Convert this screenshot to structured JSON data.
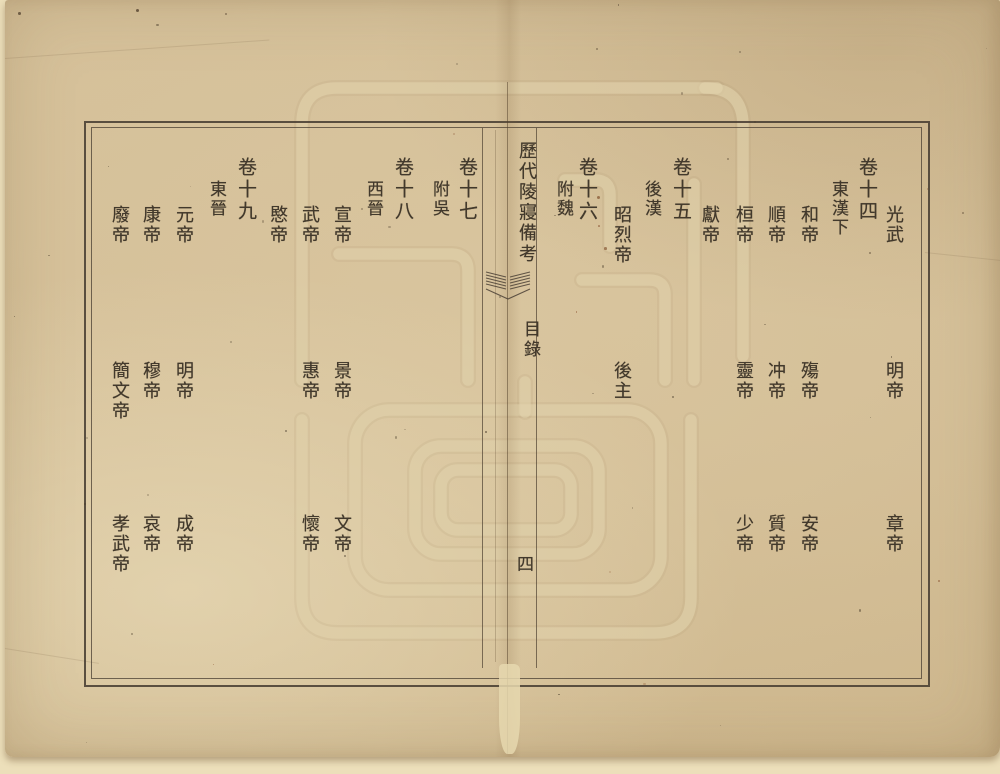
{
  "page_meta": {
    "book_title": "歷代陵寢備考",
    "section_title": "目錄",
    "folio_number": "四"
  },
  "icons": {
    "center_ornament": "fishtail-ornament",
    "background_mark": "library-seal-watermark"
  },
  "colors": {
    "paper": "#d3bd96",
    "ink": "#42392c",
    "frame": "#4a3f34",
    "watermark": "#e2d4ad"
  },
  "toc": {
    "right_page": {
      "columns": [
        {
          "kind": "entries",
          "items": [
            {
              "row": 1,
              "text": "光武"
            },
            {
              "row": 2,
              "text": "明帝"
            },
            {
              "row": 3,
              "text": "章帝"
            }
          ]
        },
        {
          "kind": "chapter",
          "text": "卷十四"
        },
        {
          "kind": "subtitle",
          "text": "東漢下"
        },
        {
          "kind": "entries",
          "items": [
            {
              "row": 1,
              "text": "和帝"
            },
            {
              "row": 2,
              "text": "殤帝"
            },
            {
              "row": 3,
              "text": "安帝"
            }
          ]
        },
        {
          "kind": "entries",
          "items": [
            {
              "row": 1,
              "text": "順帝"
            },
            {
              "row": 2,
              "text": "冲帝"
            },
            {
              "row": 3,
              "text": "質帝"
            }
          ]
        },
        {
          "kind": "entries",
          "items": [
            {
              "row": 1,
              "text": "桓帝"
            },
            {
              "row": 2,
              "text": "靈帝"
            },
            {
              "row": 3,
              "text": "少帝"
            }
          ]
        },
        {
          "kind": "entries",
          "items": [
            {
              "row": 1,
              "text": "獻帝"
            }
          ]
        },
        {
          "kind": "chapter",
          "text": "卷十五"
        },
        {
          "kind": "subtitle",
          "text": "後漢"
        },
        {
          "kind": "entries",
          "items": [
            {
              "row": 1,
              "text": "昭烈帝"
            },
            {
              "row": 2,
              "text": "後主"
            }
          ]
        },
        {
          "kind": "chapter",
          "text": "卷十六"
        },
        {
          "kind": "subtitle",
          "text": "附魏"
        }
      ]
    },
    "left_page": {
      "columns": [
        {
          "kind": "chapter",
          "text": "卷十七"
        },
        {
          "kind": "subtitle",
          "text": "附吳"
        },
        {
          "kind": "chapter",
          "text": "卷十八"
        },
        {
          "kind": "subtitle",
          "text": "西晉"
        },
        {
          "kind": "entries",
          "items": [
            {
              "row": 1,
              "text": "宣帝"
            },
            {
              "row": 2,
              "text": "景帝"
            },
            {
              "row": 3,
              "text": "文帝"
            }
          ]
        },
        {
          "kind": "entries",
          "items": [
            {
              "row": 1,
              "text": "武帝"
            },
            {
              "row": 2,
              "text": "惠帝"
            },
            {
              "row": 3,
              "text": "懷帝"
            }
          ]
        },
        {
          "kind": "entries",
          "items": [
            {
              "row": 1,
              "text": "愍帝"
            }
          ]
        },
        {
          "kind": "chapter",
          "text": "卷十九"
        },
        {
          "kind": "subtitle",
          "text": "東晉"
        },
        {
          "kind": "entries",
          "items": [
            {
              "row": 1,
              "text": "元帝"
            },
            {
              "row": 2,
              "text": "明帝"
            },
            {
              "row": 3,
              "text": "成帝"
            }
          ]
        },
        {
          "kind": "entries",
          "items": [
            {
              "row": 1,
              "text": "康帝"
            },
            {
              "row": 2,
              "text": "穆帝"
            },
            {
              "row": 3,
              "text": "哀帝"
            }
          ]
        },
        {
          "kind": "entries",
          "items": [
            {
              "row": 1,
              "text": "廢帝"
            },
            {
              "row": 2,
              "text": "簡文帝"
            },
            {
              "row": 3,
              "text": "孝武帝"
            }
          ]
        }
      ]
    }
  }
}
